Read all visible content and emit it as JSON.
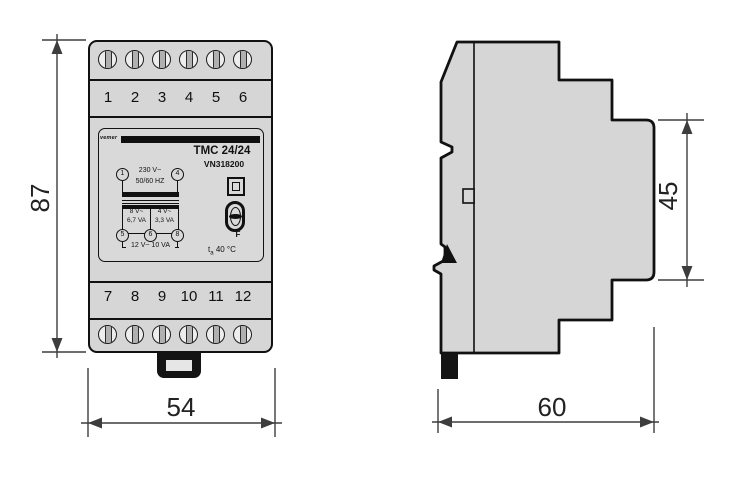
{
  "front": {
    "terminals_top": [
      "1",
      "2",
      "3",
      "4",
      "5",
      "6"
    ],
    "terminals_bottom": [
      "7",
      "8",
      "9",
      "10",
      "11",
      "12"
    ],
    "label": {
      "brand": "vemer",
      "model": "TMC 24/24",
      "code": "VN318200",
      "primary_terminal_left": "1",
      "primary_terminal_right": "4",
      "primary_voltage": "230 V~",
      "primary_frequency": "50/60 HZ",
      "sec_left_voltage": "8 V~",
      "sec_left_power": "6,7 VA",
      "sec_right_voltage": "4 V~",
      "sec_right_power": "3,3 VA",
      "sec_terminal_left": "5",
      "sec_terminal_mid": "6",
      "sec_terminal_right": "8",
      "sec_total": "12 V~ 10 VA",
      "fuse": "F",
      "ambient_symbol": "t",
      "ambient_sub": "a",
      "ambient_value": "40 °C"
    }
  },
  "dimensions": {
    "overall_height_mm": "87",
    "overall_width_mm": "54",
    "front_face_height_mm": "45",
    "depth_mm": "60"
  },
  "colors": {
    "body_fill": "#d6d6d6",
    "outline": "#111111",
    "dimension": "#3d3d3d"
  }
}
